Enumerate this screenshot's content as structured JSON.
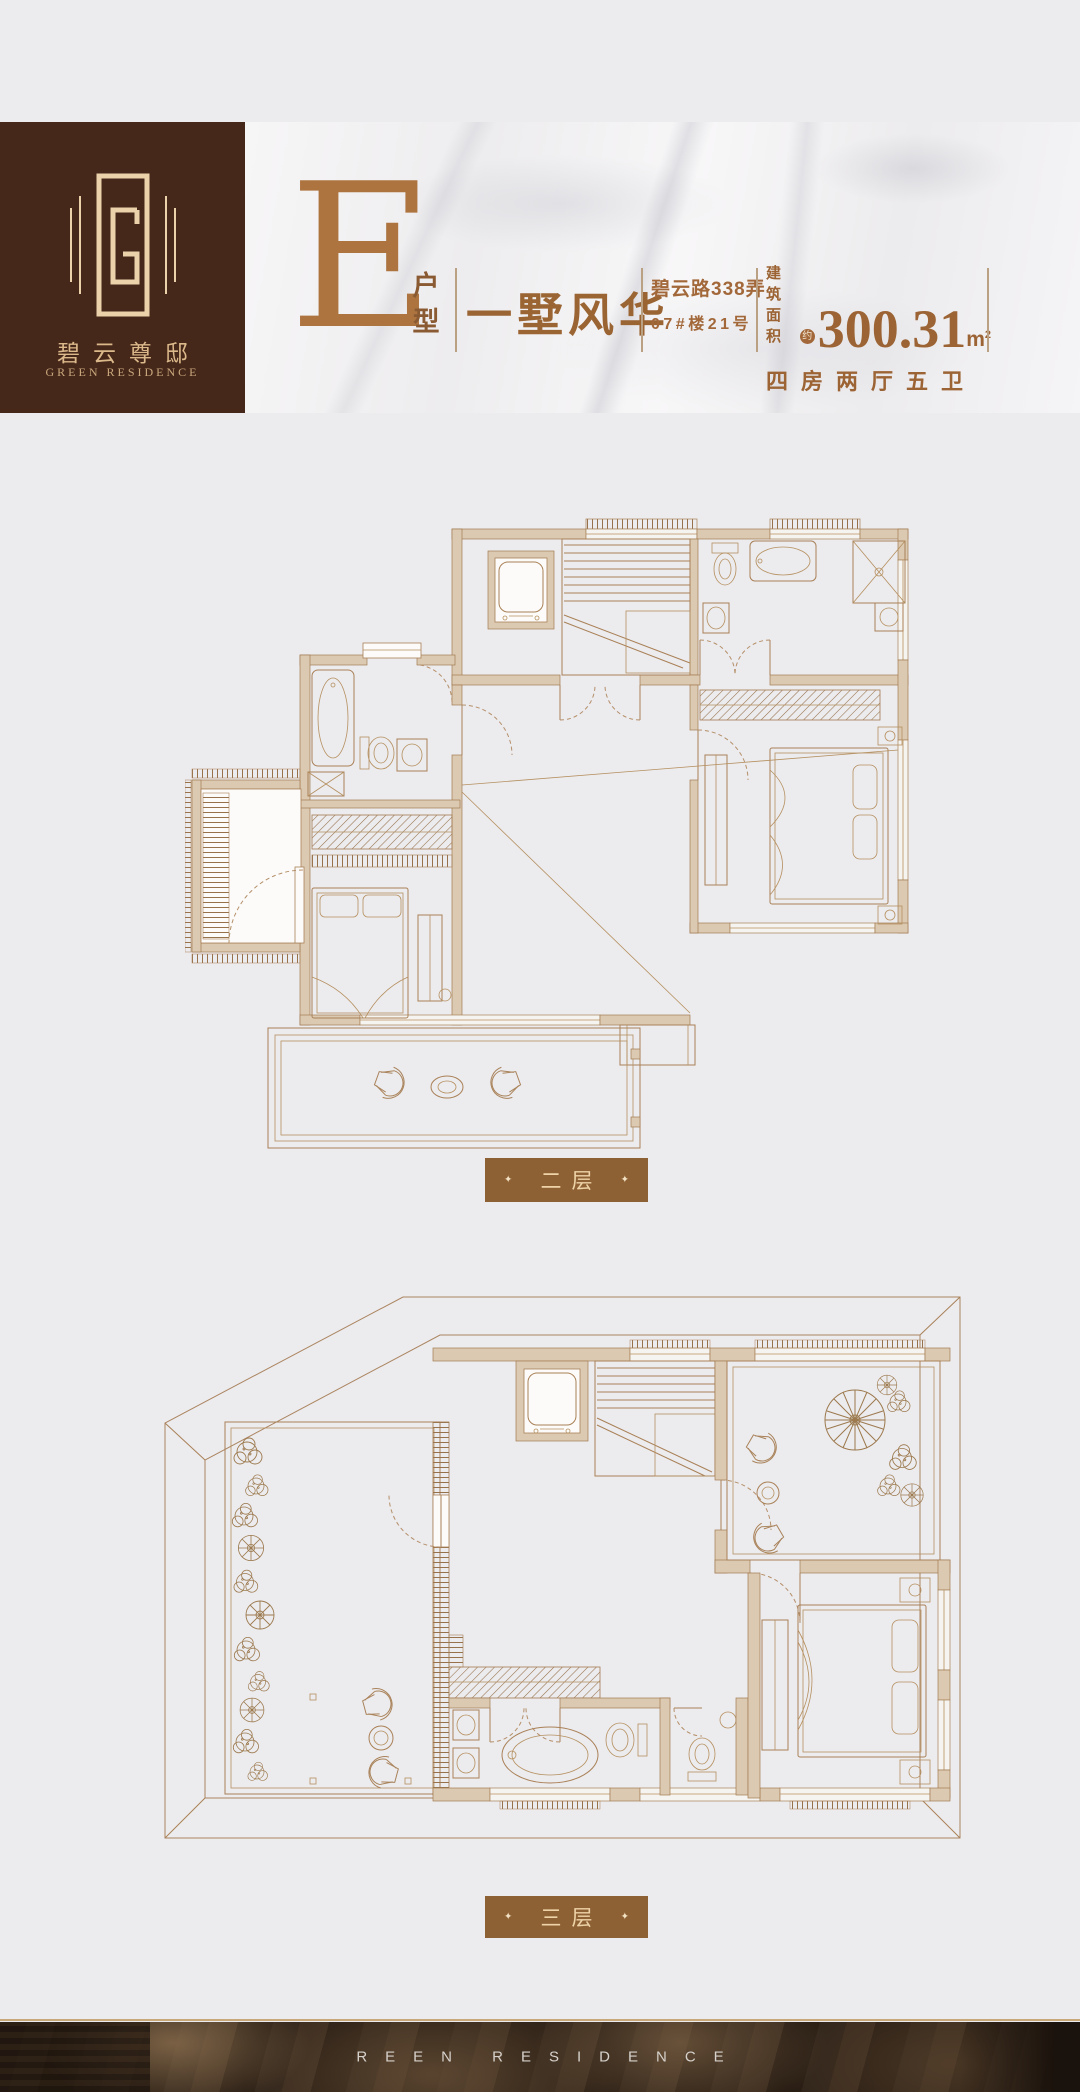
{
  "logo": {
    "monogram": "G-monogram",
    "name_cn": "碧云尊邸",
    "name_en": "GREEN RESIDENCE"
  },
  "banner": {
    "unit_letter": "E",
    "unit_suffix_top": "户",
    "unit_suffix_bottom": "型",
    "tagline": "一墅风华",
    "address_line1": "碧云路338弄",
    "address_line2": "07#楼21号",
    "area_label": "建筑面积",
    "area_approx": "约",
    "area_value": "300.31",
    "area_unit": "m",
    "area_unit_sup": "2",
    "layout_text": "四房两厅五卫"
  },
  "floors": [
    {
      "label": "二层",
      "bullet": "✦"
    },
    {
      "label": "三层",
      "bullet": "✦"
    }
  ],
  "footer": {
    "text": "REEN RESIDENCE"
  },
  "colors": {
    "brand_brown": "#46281a",
    "copper": "#ad7440",
    "heading_brown": "#9c6434",
    "label_bg": "#8d6134",
    "cream": "#eed3a8",
    "plan_line": "#a98157",
    "plan_wall": "#dbc9b2",
    "page_bg": "#ecebee",
    "marble": "#f4f3f4",
    "gold_line": "#c8a878",
    "footer_bg": "#2a1f15",
    "footer_text": "#d6d1cb"
  }
}
